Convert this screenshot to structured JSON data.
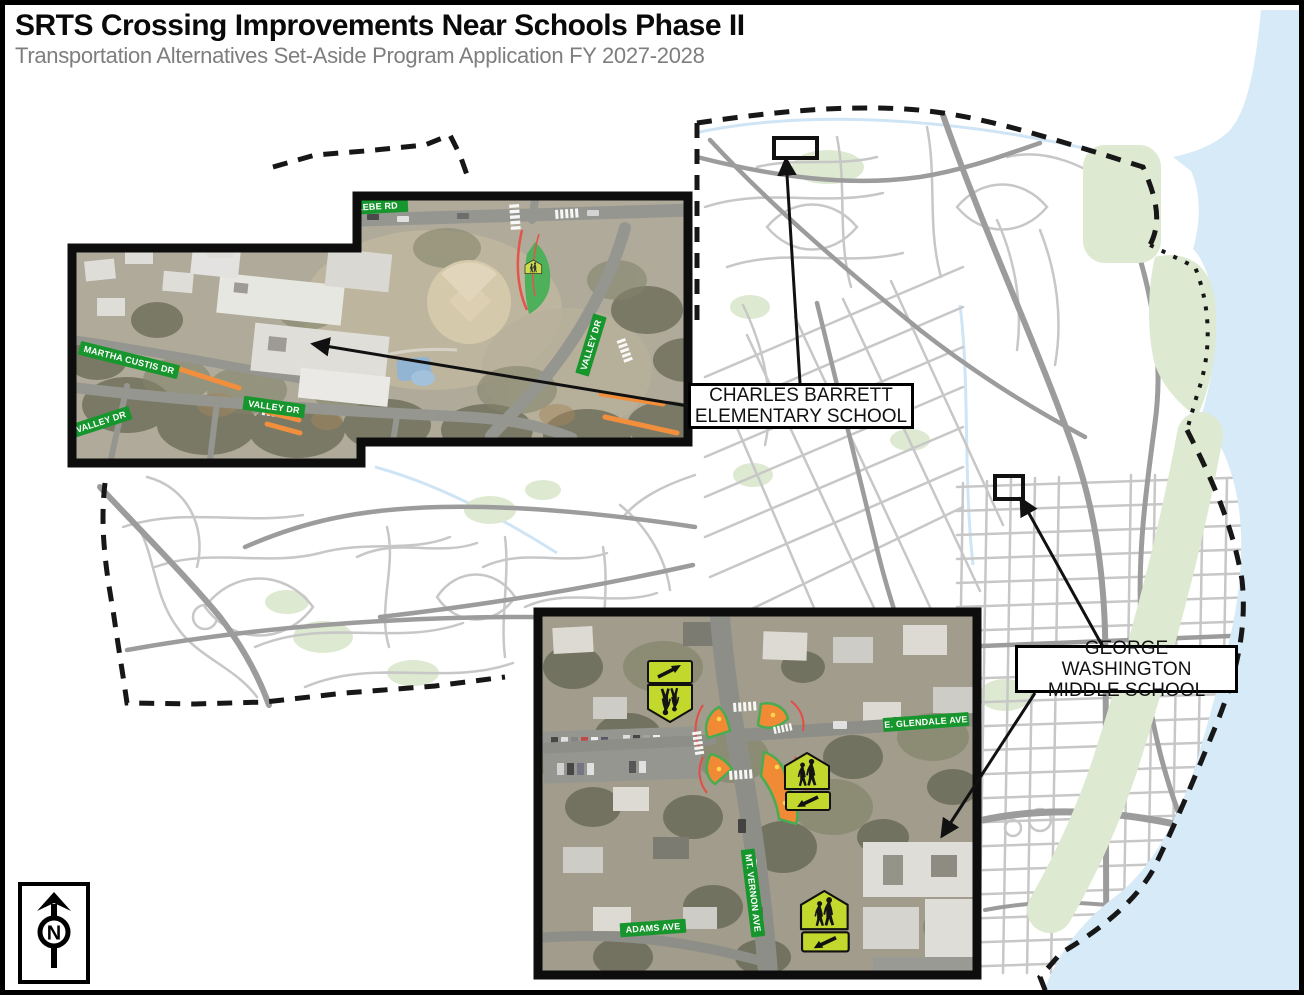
{
  "header": {
    "title": "SRTS Crossing Improvements Near Schools Phase II",
    "subtitle": "Transportation Alternatives Set-Aside Program Application FY 2027-2028"
  },
  "callouts": {
    "barrett": {
      "line1": "CHARLES BARRETT",
      "line2": "ELEMENTARY SCHOOL"
    },
    "washington": {
      "line1": "GEORGE WASHINGTON",
      "line2": "MIDDLE SCHOOL"
    }
  },
  "inset_barrett": {
    "streets": {
      "glebe": "W. GLEBE RD",
      "valley_right": "VALLEY DR",
      "martha_custis": "MARTHA CUSTIS DR",
      "valley_left": "VALLEY DR",
      "valley_mid": "VALLEY DR"
    }
  },
  "inset_washington": {
    "streets": {
      "glendale": "E. GLENDALE AVE",
      "mt_vernon": "MT. VERNON AVE",
      "adams": "ADAMS AVE"
    }
  },
  "north_arrow": {
    "label": "N"
  },
  "colors": {
    "water": "#d7eaf8",
    "park": "#dde9d0",
    "road_minor": "#c7c7c7",
    "road_major": "#9c9c9c",
    "boundary": "#171717",
    "leader_black": "#111111",
    "street_sign_green": "#18962e",
    "school_sign_yellow_green": "#c3d82d",
    "improvement_orange": "#f07d1e",
    "safety_green": "#33a341",
    "curb_red": "#e0392e",
    "aerial_base": "#a39d8a",
    "aerial_base_2": "#97917e"
  }
}
